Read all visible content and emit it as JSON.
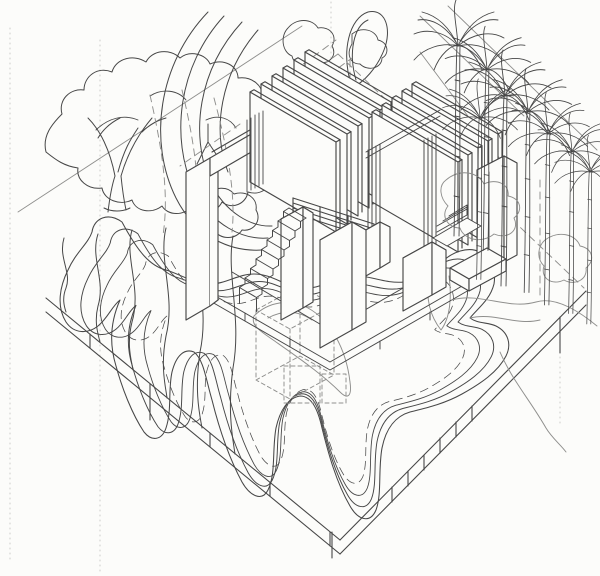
{
  "canvas": {
    "width": 600,
    "height": 576
  },
  "colors": {
    "paper": "#fcfcfa",
    "ink": "#474747",
    "ink_light": "#8f8f8d",
    "ink_faint": "#c8c8c4"
  },
  "scene": {
    "labels": {
      "drawing": "axonometric-architectural-site-drawing",
      "site_base": "site-base-plinth",
      "landform": "meandering-contour-landform",
      "tree": "deciduous-tree",
      "palms": "palm-grove",
      "gates": "slatted-gate-pavilions",
      "towers": "tower-blocks",
      "stairs": "staircase",
      "construction": "dashed-construction-lines",
      "shrubs": "ground-vegetation",
      "ribbons": "curved-ramp-bands"
    }
  }
}
